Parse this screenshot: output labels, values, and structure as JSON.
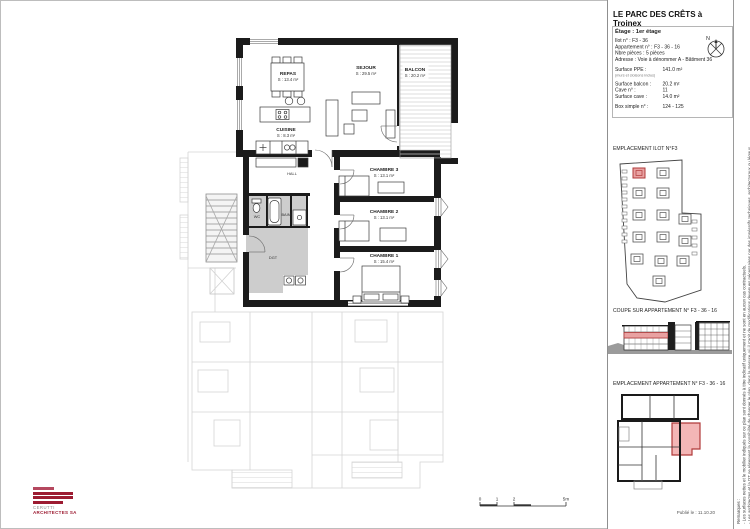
{
  "header": {
    "title": "LE PARC DES CRÊTS à Troinex",
    "floor_label": "Étage : 1er étage",
    "north_label": "N"
  },
  "info": {
    "ilot": {
      "label": "Ilot n° :",
      "value": "F3 - 36"
    },
    "apartment": {
      "label": "Appartement n° :",
      "value": "F3 - 36 - 16"
    },
    "pieces": {
      "label": "Nbre pièces :",
      "value": "5 pièces"
    },
    "address": {
      "label": "Adresse :",
      "value": "Voie à dénommer A - Bâtiment 36"
    },
    "ppe": {
      "label": "Surface PPE :",
      "note": "(murs et cloisons inclus)",
      "value": "141.0 m²"
    },
    "balcon": {
      "label": "Surface balcon :",
      "value": "20.2 m²"
    },
    "cave_no": {
      "label": "Cave n° :",
      "value": "11"
    },
    "cave_surface": {
      "label": "Surface cave :",
      "value": "14.0 m²"
    },
    "box": {
      "label": "Box simple n° :",
      "value": "124 - 125"
    }
  },
  "sections": {
    "block_location": "EMPLACEMENT ILOT N°F3",
    "section_cut": "COUPE SUR APPARTEMENT N° F3 - 36 - 16",
    "apartment_location": "EMPLACEMENT APPARTEMENT N° F3 - 36 - 16"
  },
  "plan": {
    "rooms": {
      "repas": {
        "name": "REPAS",
        "area": "S : 13.4 m²"
      },
      "sejour": {
        "name": "SEJOUR",
        "area": "S : 29.5 m²"
      },
      "cuisine": {
        "name": "CUISINE",
        "area": "S : 8.3 m²"
      },
      "balcon": {
        "name": "BALCON",
        "area": "S : 20.2 m²"
      },
      "hall": {
        "name": "HALL"
      },
      "wc": {
        "name": "WC"
      },
      "bain": {
        "name": "BAIN"
      },
      "dgt": {
        "name": "DGT"
      },
      "chambre3": {
        "name": "CHAMBRE 3",
        "area": "S : 13.1 m²"
      },
      "chambre2": {
        "name": "CHAMBRE 2",
        "area": "S : 13.1 m²"
      },
      "chambre1": {
        "name": "CHAMBRE 1",
        "area": "S : 15.4 m²"
      }
    }
  },
  "remarks": {
    "title": "Remarques :",
    "line1": "- Les surfaces nettes et le mobilier indiqués sur ce plan sont donnés à titre indicatif uniquement et ne sont en aucun cas contractuels.",
    "line2": "- Les architectes et la DT se réservent la possibilité de changer le plan, dans la mesure où il s'agit de modifications devenues nécessaires par des impératifs techniques, architecturaux ou légaux."
  },
  "footer": {
    "published": "Publié le : 11.10.20",
    "logo_line1": "CERUTTI",
    "logo_line2": "ARCHITECTES SA",
    "scale_ticks": [
      "0",
      "1",
      "2",
      "5m"
    ]
  },
  "colors": {
    "accent_red": "#b03a3a",
    "highlight_fill": "#efb0b0",
    "logo_maroon": "#9c1b31",
    "wall_black": "#1b1b1b",
    "wet_room_gray": "#cdcdcd",
    "ghost_gray": "#d4d4d4"
  }
}
